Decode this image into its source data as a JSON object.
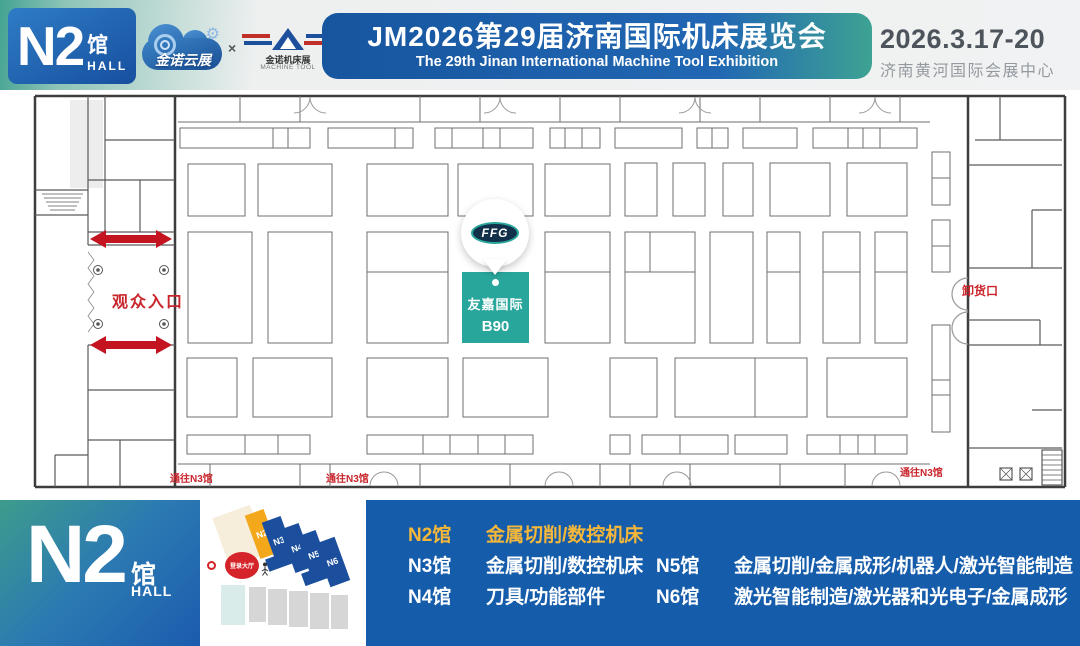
{
  "header": {
    "hall_badge": {
      "code": "N2",
      "suffix_cn": "馆",
      "suffix_en": "HALL"
    },
    "logo_cloud": {
      "text": "金诺云展",
      "gear_icon": "⚙"
    },
    "logo_multiplier": "×",
    "logo_machine": {
      "text": "金诺机床展",
      "subtext": "MACHINE TOOL"
    },
    "title": {
      "cn": "JM2026第29届济南国际机床展览会",
      "en": "The 29th Jinan International Machine Tool Exhibition"
    },
    "date": "2026.3.17-20",
    "venue": "济南黄河国际会展中心"
  },
  "floorplan": {
    "visitor_entrance": "观众入口",
    "unloading_gate": "卸货口",
    "to_n3_labels": [
      "通往N3馆",
      "通往N3馆",
      "通往N3馆"
    ],
    "booth": {
      "logo": "FFG",
      "name": "友嘉国际",
      "number": "B90"
    }
  },
  "footer": {
    "hall": {
      "code": "N2",
      "suffix_cn": "馆",
      "suffix_en": "HALL"
    },
    "minimap": {
      "halls": [
        "N2",
        "N3",
        "N4",
        "N5",
        "N6"
      ],
      "highlight": "N2",
      "registration": "登录大厅"
    },
    "legend": [
      {
        "hall": "N2馆",
        "desc": "金属切削/数控机床"
      },
      {
        "hall": "N3馆",
        "desc": "金属切削/数控机床"
      },
      {
        "hall": "N4馆",
        "desc": "刀具/功能部件"
      },
      {
        "hall": "N5馆",
        "desc": "金属切削/金属成形/机器人/激光智能制造"
      },
      {
        "hall": "N6馆",
        "desc": "激光智能制造/激光器和光电子/金属成形"
      }
    ]
  },
  "colors": {
    "accent_teal": "#29a69b",
    "brand_blue": "#155cab",
    "highlight_gold": "#f5b73a",
    "map_red": "#c9252c",
    "minimap_hall_blue": "#1b4f9e",
    "minimap_hall_yellow": "#f3a81c"
  }
}
